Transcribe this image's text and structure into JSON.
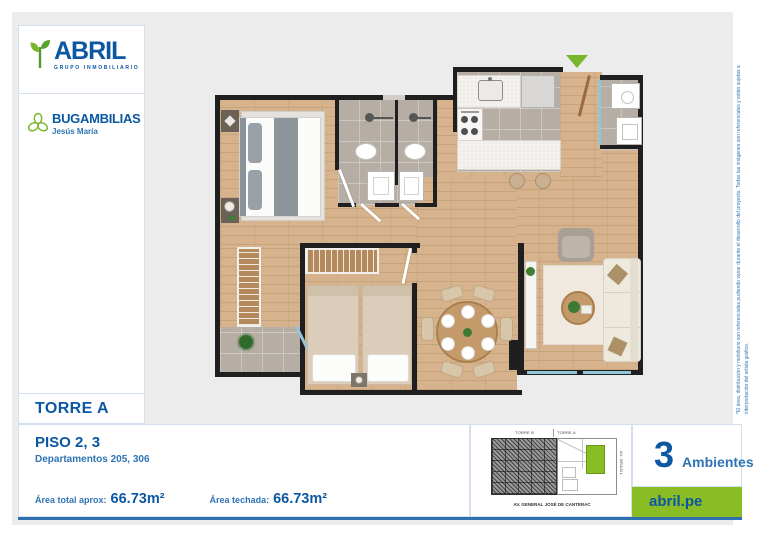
{
  "page": {
    "background": "#ececec",
    "accent_blue": "#0b57a2",
    "accent_green": "#8abc23",
    "bottom_rule_color": "#2e71ae"
  },
  "brand": {
    "name": "ABRIL",
    "tagline": "GRUPO INMOBILIARIO"
  },
  "project": {
    "name": "BUGAMBILIAS",
    "district": "Jesús María"
  },
  "tower": {
    "label": "TORRE A"
  },
  "unit": {
    "floor_title": "PISO 2, 3",
    "departments": "Departamentos 205, 306",
    "rooms_count": "3",
    "rooms_label": "Ambientes"
  },
  "areas": {
    "total_label": "Área total aprox:",
    "total_value": "66.73m²",
    "covered_label": "Área techada:",
    "covered_value": "66.73m²"
  },
  "sitemap": {
    "tower_left": "TORRE B",
    "tower_right": "TORRE A",
    "street_bottom": "AV. GENERAL JOSÉ DE CANTERAC",
    "street_right": "AV. BRASIL"
  },
  "footer": {
    "website": "abril.pe"
  },
  "icons": {
    "leaf": "abril-leaf-icon",
    "flower": "bugambilias-flower-icon",
    "entry_arrow": "entry-arrow-icon"
  },
  "disclaimer": "*El área, distribución y mobiliario son referenciales pudiendo variar durante el desarrollo del proyecto. Todas las imágenes son referenciales y están sujetas a interpretación del artista gráfico."
}
